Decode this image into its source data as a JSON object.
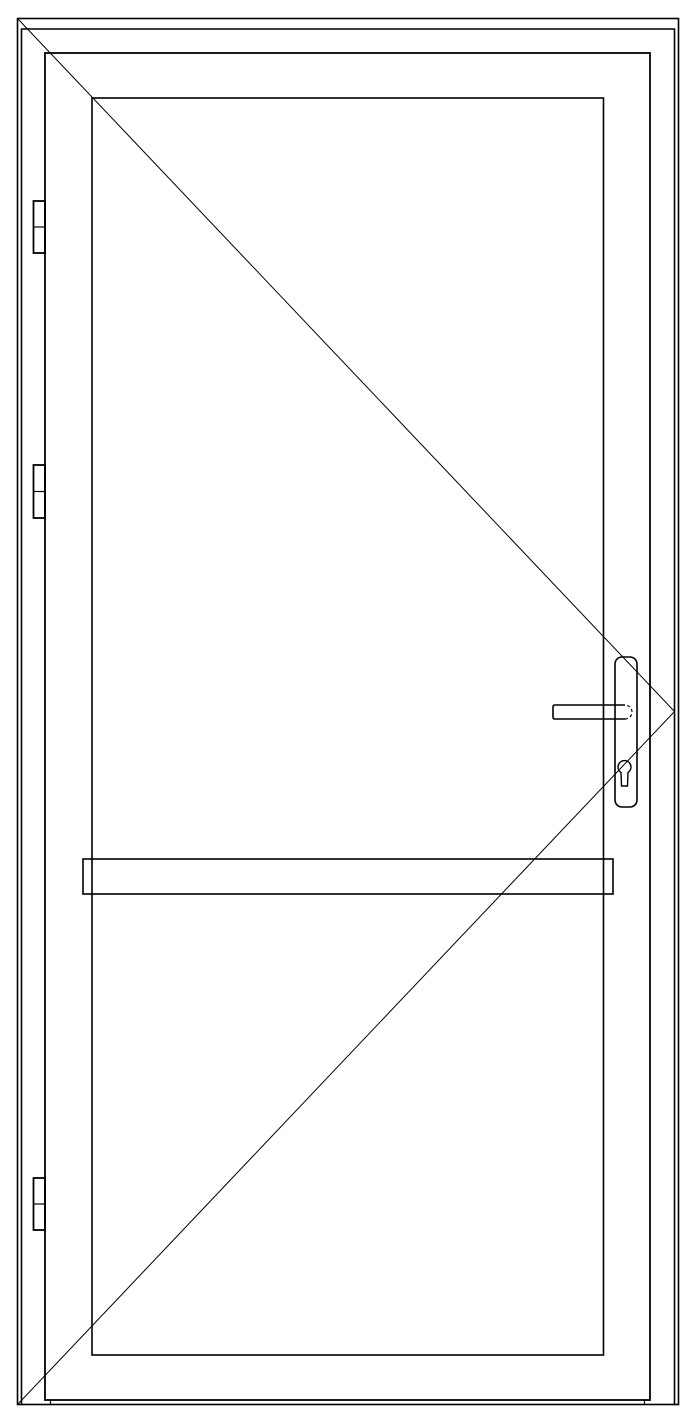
{
  "canvas": {
    "width": 695,
    "height": 1419,
    "background": "#ffffff",
    "stroke": "#000000"
  },
  "drawing": {
    "kind": "door-elevation-technical-drawing",
    "hinge_side": "left",
    "handle_side": "right",
    "shapes": [
      {
        "name": "opening-outer-outline",
        "type": "rect",
        "x": 17.5,
        "y": 18.5,
        "w": 661,
        "h": 1386,
        "sw": 1.6
      },
      {
        "name": "frame-outline",
        "type": "path",
        "d": "M 21.5 1404.5 L 21.5 29 L 674.5 29 L 674.5 1404.5",
        "sw": 1.6
      },
      {
        "name": "door-leaf-outline",
        "type": "rect",
        "x": 45,
        "y": 53,
        "w": 605,
        "h": 1347,
        "sw": 1.8
      },
      {
        "name": "glass-panel-outline",
        "type": "rect",
        "x": 92,
        "y": 98,
        "w": 511.5,
        "h": 1257,
        "sw": 1.6
      },
      {
        "name": "swing-indicator-upper-line",
        "type": "line",
        "x1": 18,
        "y1": 19,
        "x2": 674.5,
        "y2": 711.5,
        "sw": 1
      },
      {
        "name": "swing-indicator-lower-line",
        "type": "line",
        "x1": 674.5,
        "y1": 711.5,
        "x2": 18,
        "y2": 1404,
        "sw": 1
      },
      {
        "name": "push-bar-outline",
        "type": "rect",
        "x": 83,
        "y": 859,
        "w": 530,
        "h": 35,
        "sw": 1.6
      },
      {
        "name": "hinge-top-outline",
        "type": "rect",
        "x": 33.5,
        "y": 201,
        "w": 11.5,
        "h": 52,
        "sw": 1.8
      },
      {
        "name": "hinge-top-divider",
        "type": "line",
        "x1": 33.5,
        "y1": 227,
        "x2": 45,
        "y2": 227,
        "sw": 1.2
      },
      {
        "name": "hinge-middle-outline",
        "type": "rect",
        "x": 33.5,
        "y": 465,
        "w": 11.5,
        "h": 53,
        "sw": 1.8
      },
      {
        "name": "hinge-middle-divider",
        "type": "line",
        "x1": 33.5,
        "y1": 491.5,
        "x2": 45,
        "y2": 491.5,
        "sw": 1.2
      },
      {
        "name": "hinge-bottom-outline",
        "type": "rect",
        "x": 33.5,
        "y": 1178,
        "w": 11.5,
        "h": 52,
        "sw": 1.8
      },
      {
        "name": "hinge-bottom-divider",
        "type": "line",
        "x1": 33.5,
        "y1": 1204,
        "x2": 45,
        "y2": 1204,
        "sw": 1.2
      },
      {
        "name": "handle-backplate-outline",
        "type": "rect",
        "x": 615,
        "y": 657,
        "w": 22,
        "h": 150,
        "rx": 7,
        "sw": 1.6
      },
      {
        "name": "handle-lever-outline",
        "type": "path",
        "d": "M 625 705 L 555 705 Q 553 705 553 707 L 553 717 Q 553 719 555 719 L 625 719",
        "sw": 1.6
      },
      {
        "name": "handle-lever-hidden-endcap",
        "type": "path",
        "d": "M 625 719 A 7 7 0 0 0 625 705",
        "sw": 1.2,
        "dash": "3 2.5"
      },
      {
        "name": "key-cylinder-outline",
        "type": "path",
        "d": "M 628 772.5 A 6.5 6.5 0 1 0 621 772.5 L 621.5 786 L 627.5 786 Z",
        "sw": 1.4
      },
      {
        "name": "threshold-tick-left",
        "type": "line",
        "x1": 50.5,
        "y1": 1400,
        "x2": 50.5,
        "y2": 1404.5,
        "sw": 1.2
      },
      {
        "name": "threshold-tick-right",
        "type": "line",
        "x1": 644.5,
        "y1": 1400,
        "x2": 644.5,
        "y2": 1404.5,
        "sw": 1.2
      }
    ]
  }
}
